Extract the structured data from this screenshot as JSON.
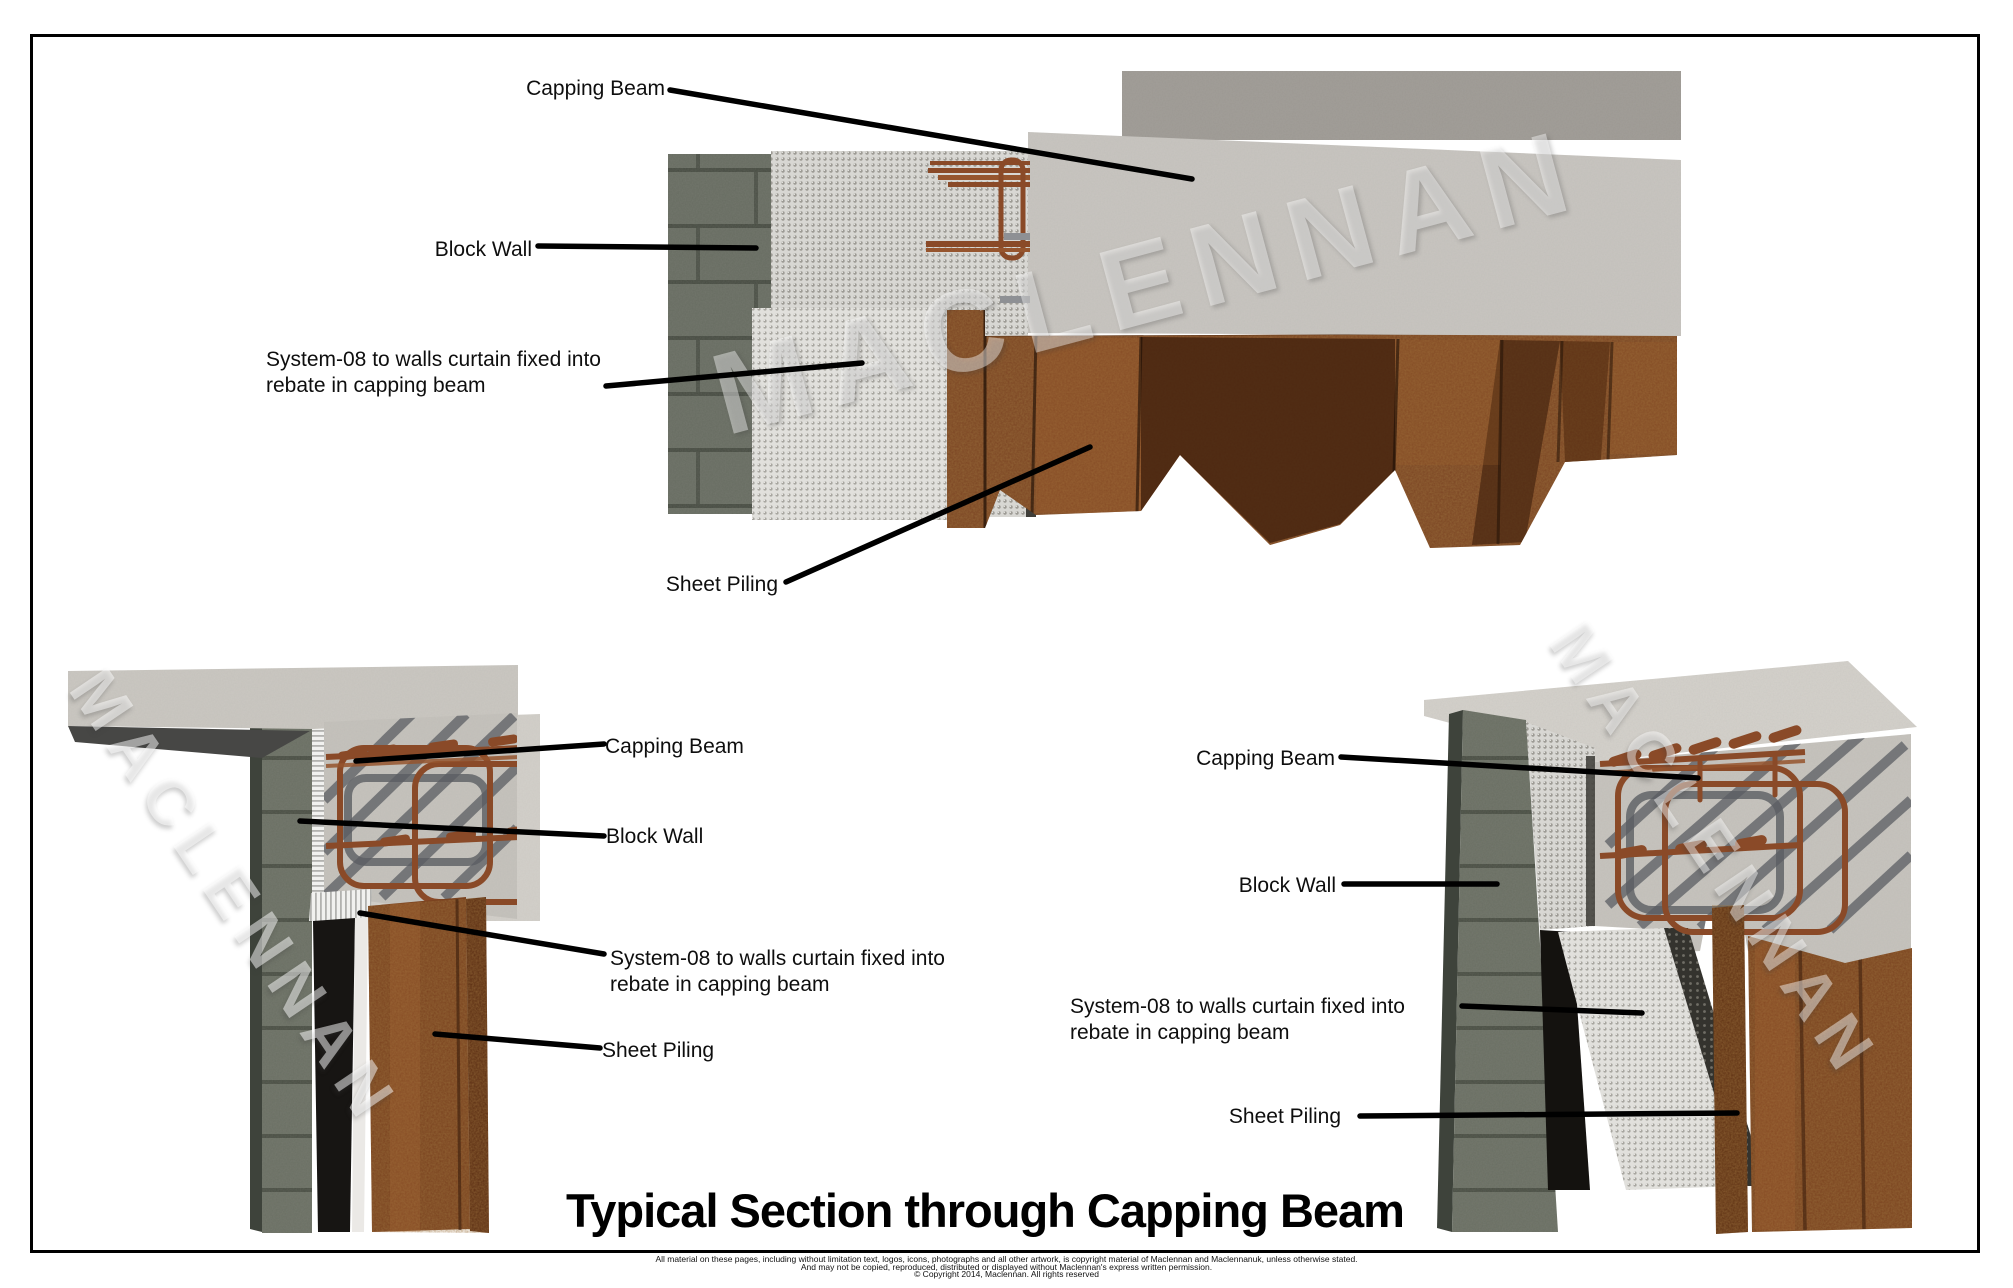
{
  "sheet": {
    "watermark_text": "MACLENNAN",
    "title": "Typical Section through Capping Beam",
    "footer_line1": "All material on these pages, including without limitation text, logos, icons, photographs and all other artwork, is copyright material of Maclennan and Maclennanuk, unless otherwise stated.",
    "footer_line2": "And may not be copied, reproduced, distributed or displayed without Maclennan's express written permission.",
    "footer_line3": "© Copyright 2014, Maclennan.  All rights reserved"
  },
  "labels": {
    "top": {
      "capping_beam": "Capping Beam",
      "block_wall": "Block Wall",
      "system08_line1": "System-08 to walls curtain fixed into",
      "system08_line2": "rebate in capping beam",
      "sheet_piling": "Sheet Piling"
    },
    "bottom_left": {
      "capping_beam": "Capping Beam",
      "block_wall": "Block Wall",
      "system08_line1": "System-08 to walls curtain fixed into",
      "system08_line2": "rebate in capping beam",
      "sheet_piling": "Sheet Piling"
    },
    "bottom_right": {
      "capping_beam": "Capping Beam",
      "block_wall": "Block Wall",
      "system08_line1": "System-08 to walls curtain fixed into",
      "system08_line2": "rebate in capping beam",
      "sheet_piling": "Sheet Piling"
    }
  },
  "colors": {
    "concrete": "#c9c6c1",
    "concrete_rough": "#9c9892",
    "block_wall": "#676c61",
    "membrane": "#dbdad6",
    "rust_steel": "#7a421f",
    "rebar": "#8a4a28",
    "leader_line": "#000000",
    "label_text": "#0e0e0e",
    "watermark": "rgba(255,255,255,0.45)"
  }
}
